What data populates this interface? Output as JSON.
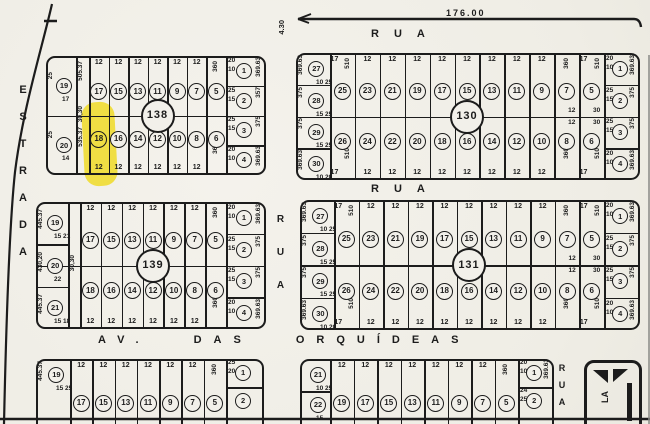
{
  "document": {
    "type": "scanned cadastral plat map (loteamento)"
  },
  "colors": {
    "paper": "#f2f0ea",
    "ink": "#1c1c1c",
    "highlight": "#f0dc35"
  },
  "measurements": {
    "top_length": "176.00",
    "top_side": "4.30"
  },
  "streets": {
    "left": "ESTRADA",
    "top": "RUA",
    "middle": "RUA",
    "center_vertical": "RUA",
    "bottom_avenue": "AV. DAS ORQUÍDEAS",
    "bottom_right_vertical": "RUA",
    "corner_label": "LA"
  },
  "highlight": {
    "block": "138",
    "lot": "18"
  },
  "blocks": [
    {
      "id": "138",
      "number": "138",
      "highlight_lot": "18",
      "left_lots": [
        {
          "n": "19",
          "side": "25",
          "small": [
            "17"
          ]
        },
        {
          "n": "20",
          "side": "25",
          "small": [
            "14"
          ]
        }
      ],
      "strip": {
        "top": "505.37",
        "mid": "30,30",
        "bottom": "535.37"
      },
      "cols": [
        {
          "t": "17",
          "b": "18",
          "tl": "12",
          "bl": "12"
        },
        {
          "t": "15",
          "b": "16",
          "tl": "12",
          "bl": "12"
        },
        {
          "t": "13",
          "b": "14",
          "tl": "12",
          "bl": "12"
        },
        {
          "t": "11",
          "b": "12",
          "tl": "12",
          "bl": "12"
        },
        {
          "t": "9",
          "b": "10",
          "tl": "12",
          "bl": "12"
        },
        {
          "t": "7",
          "b": "8",
          "tl": "12",
          "bl": "12"
        },
        {
          "t": "5",
          "b": "6",
          "dims": [
            "360",
            "360"
          ]
        }
      ],
      "right_lots": [
        {
          "n": "1",
          "side": "369.63",
          "small": [
            "20",
            "10"
          ]
        },
        {
          "n": "2",
          "side": "357",
          "small": [
            "25",
            "15"
          ]
        },
        {
          "n": "3",
          "side": "375",
          "small": [
            "25",
            "15"
          ]
        },
        {
          "n": "4",
          "side": "369.63",
          "small": [
            "20",
            "10"
          ]
        }
      ]
    },
    {
      "id": "130",
      "number": "130",
      "left_lots": [
        {
          "n": "27",
          "side": "369.63",
          "small": [
            "10",
            "25"
          ]
        },
        {
          "n": "28",
          "side": "375",
          "small": [
            "15",
            "25"
          ]
        },
        {
          "n": "29",
          "side": "375",
          "small": [
            "15",
            "25"
          ]
        },
        {
          "n": "30",
          "side": "369.63",
          "small": [
            "10",
            "20"
          ]
        }
      ],
      "cols": [
        {
          "t": "25",
          "b": "26",
          "tl": "17",
          "bl": "17",
          "dims": [
            "510",
            "510"
          ]
        },
        {
          "t": "23",
          "b": "24",
          "tl": "12",
          "bl": "12"
        },
        {
          "t": "21",
          "b": "22",
          "tl": "12",
          "bl": "12"
        },
        {
          "t": "19",
          "b": "20",
          "tl": "12",
          "bl": "12"
        },
        {
          "t": "17",
          "b": "18",
          "tl": "12",
          "bl": "12"
        },
        {
          "t": "15",
          "b": "16",
          "tl": "12",
          "bl": "12"
        },
        {
          "t": "13",
          "b": "14",
          "tl": "12",
          "bl": "12"
        },
        {
          "t": "11",
          "b": "12",
          "tl": "12",
          "bl": "12"
        },
        {
          "t": "9",
          "b": "10",
          "tl": "12",
          "bl": "12"
        },
        {
          "t": "7",
          "b": "8",
          "dims": [
            "360",
            "360"
          ],
          "mid": [
            "12",
            "12"
          ]
        },
        {
          "t": "5",
          "b": "6",
          "tl": "17",
          "bl": "17",
          "dims": [
            "510",
            "510"
          ],
          "mid": [
            "30",
            "30"
          ]
        }
      ],
      "right_lots": [
        {
          "n": "1",
          "side": "369.63",
          "small": [
            "20",
            "10"
          ]
        },
        {
          "n": "2",
          "side": "375",
          "small": [
            "25",
            "15"
          ]
        },
        {
          "n": "3",
          "side": "375",
          "small": [
            "25",
            "15"
          ]
        },
        {
          "n": "4",
          "side": "369.63",
          "small": [
            "20",
            "10"
          ]
        }
      ]
    },
    {
      "id": "139",
      "number": "139",
      "left_lots": [
        {
          "n": "19",
          "side": "445.37",
          "small": [
            "15",
            "21"
          ]
        },
        {
          "n": "20",
          "side": "430,20",
          "small": [
            "22"
          ]
        },
        {
          "n": "21",
          "side": "445.37",
          "small": [
            "15",
            "18"
          ]
        }
      ],
      "strip": {
        "mid": "30,30"
      },
      "cols": [
        {
          "t": "17",
          "b": "18",
          "tl": "12",
          "bl": "12"
        },
        {
          "t": "15",
          "b": "16",
          "tl": "12",
          "bl": "12"
        },
        {
          "t": "13",
          "b": "14",
          "tl": "12",
          "bl": "12"
        },
        {
          "t": "11",
          "b": "12",
          "tl": "12",
          "bl": "12"
        },
        {
          "t": "9",
          "b": "10",
          "tl": "12",
          "bl": "12"
        },
        {
          "t": "7",
          "b": "8",
          "tl": "12",
          "bl": "12"
        },
        {
          "t": "5",
          "b": "6",
          "dims": [
            "360",
            "360"
          ]
        }
      ],
      "right_lots": [
        {
          "n": "1",
          "side": "369.63",
          "small": [
            "20",
            "10"
          ]
        },
        {
          "n": "2",
          "side": "375",
          "small": [
            "25",
            "15"
          ]
        },
        {
          "n": "3",
          "side": "375",
          "small": [
            "25",
            "15"
          ]
        },
        {
          "n": "4",
          "side": "369.63",
          "small": [
            "20",
            "10"
          ]
        }
      ]
    },
    {
      "id": "131",
      "number": "131",
      "left_lots": [
        {
          "n": "27",
          "side": "369.63",
          "small": [
            "10",
            "25"
          ]
        },
        {
          "n": "28",
          "side": "375",
          "small": [
            "15",
            "25"
          ]
        },
        {
          "n": "29",
          "side": "375",
          "small": [
            "15",
            "25"
          ]
        },
        {
          "n": "30",
          "side": "369.63",
          "small": [
            "10",
            "20"
          ]
        }
      ],
      "cols": [
        {
          "t": "25",
          "b": "26",
          "tl": "17",
          "bl": "17",
          "dims": [
            "510",
            "510"
          ]
        },
        {
          "t": "23",
          "b": "24",
          "tl": "12",
          "bl": "12"
        },
        {
          "t": "21",
          "b": "22",
          "tl": "12",
          "bl": "12"
        },
        {
          "t": "19",
          "b": "20",
          "tl": "12",
          "bl": "12"
        },
        {
          "t": "17",
          "b": "18",
          "tl": "12",
          "bl": "12"
        },
        {
          "t": "15",
          "b": "16",
          "tl": "12",
          "bl": "12"
        },
        {
          "t": "13",
          "b": "14",
          "tl": "12",
          "bl": "12"
        },
        {
          "t": "11",
          "b": "12",
          "tl": "12",
          "bl": "12"
        },
        {
          "t": "9",
          "b": "10",
          "tl": "12",
          "bl": "12"
        },
        {
          "t": "7",
          "b": "8",
          "dims": [
            "360",
            "360"
          ],
          "mid": [
            "12",
            "12"
          ]
        },
        {
          "t": "5",
          "b": "6",
          "tl": "17",
          "bl": "17",
          "dims": [
            "510",
            "510"
          ],
          "mid": [
            "30",
            "30"
          ]
        }
      ],
      "right_lots": [
        {
          "n": "1",
          "side": "369.63",
          "small": [
            "20",
            "10"
          ]
        },
        {
          "n": "2",
          "side": "375",
          "small": [
            "25",
            "15"
          ]
        },
        {
          "n": "3",
          "side": "375",
          "small": [
            "25",
            "15"
          ]
        },
        {
          "n": "4",
          "side": "369.63",
          "small": [
            "20",
            "10"
          ]
        }
      ]
    },
    {
      "id": "bottom-left",
      "number": "",
      "partial": true,
      "left_lots": [
        {
          "n": "19",
          "side": "445.37",
          "small": [
            "15",
            "25"
          ]
        }
      ],
      "cols": [
        {
          "t": "17",
          "tl": "12"
        },
        {
          "t": "15",
          "tl": "12"
        },
        {
          "t": "13",
          "tl": "12"
        },
        {
          "t": "11",
          "tl": "12"
        },
        {
          "t": "9",
          "tl": "12"
        },
        {
          "t": "7",
          "tl": "12"
        },
        {
          "t": "5",
          "dims": [
            "360"
          ]
        }
      ],
      "right_lots": [
        {
          "n": "1",
          "small": [
            "25",
            "20"
          ]
        },
        {
          "n": "2"
        }
      ]
    },
    {
      "id": "bottom-right",
      "number": "",
      "partial": true,
      "left_lots": [
        {
          "n": "21",
          "small": [
            "10",
            "25"
          ]
        },
        {
          "n": "22",
          "small": [
            "15"
          ]
        }
      ],
      "cols": [
        {
          "t": "19",
          "tl": "12"
        },
        {
          "t": "17",
          "tl": "12"
        },
        {
          "t": "15",
          "tl": "12"
        },
        {
          "t": "13",
          "tl": "12"
        },
        {
          "t": "11",
          "tl": "12"
        },
        {
          "t": "9",
          "tl": "12"
        },
        {
          "t": "7",
          "tl": "12"
        },
        {
          "t": "5",
          "dims": [
            "360"
          ]
        }
      ],
      "right_lots": [
        {
          "n": "1",
          "side": "369.63",
          "small": [
            "20",
            "10"
          ]
        },
        {
          "n": "2",
          "small": [
            "24",
            "25"
          ]
        }
      ]
    }
  ]
}
